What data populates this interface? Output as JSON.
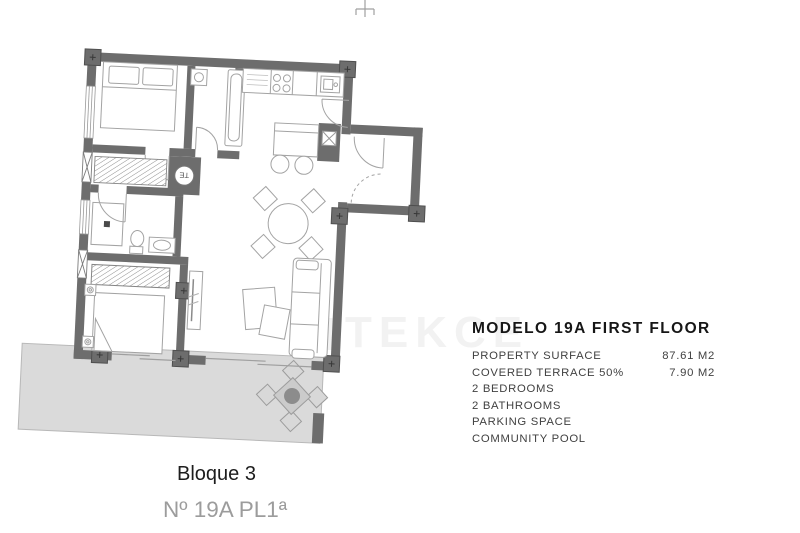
{
  "watermark": {
    "text": "TEKCE",
    "color": "#f2f2f2"
  },
  "plan": {
    "water_heater_label": "TE",
    "colors": {
      "wall": "#6d6d6d",
      "terrace_fill": "#dadada",
      "furniture_line": "#a3a3a3"
    }
  },
  "info": {
    "title": "MODELO 19A FIRST FLOOR",
    "rows": [
      {
        "label": "PROPERTY SURFACE",
        "value": "87.61 M2"
      },
      {
        "label": "COVERED TERRACE 50%",
        "value": "7.90 M2"
      },
      {
        "label": "2 BEDROOMS",
        "value": ""
      },
      {
        "label": "2 BATHROOMS",
        "value": ""
      },
      {
        "label": "PARKING SPACE",
        "value": ""
      },
      {
        "label": "COMMUNITY POOL",
        "value": ""
      }
    ]
  },
  "footer": {
    "block": "Bloque 3",
    "unit": "Nº 19A PL1ª"
  }
}
